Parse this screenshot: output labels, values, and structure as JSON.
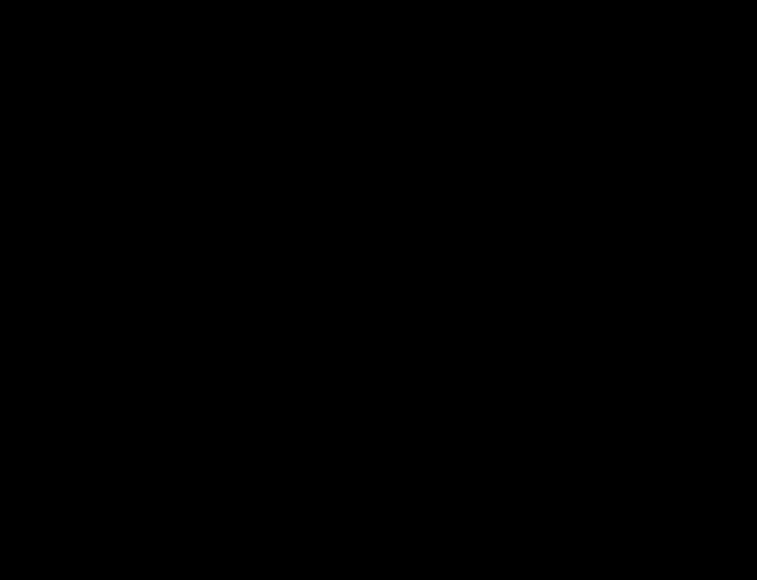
{
  "diagram": {
    "kind": "motherboard-boardview",
    "width": 757,
    "height": 580,
    "background": "#000000"
  },
  "palette": {
    "outline": "#dcdcdc",
    "outline_dim": "#8f8f8f",
    "label": "#bdbdbd",
    "label_dim": "#787878",
    "teal": "#3f9b85",
    "teal_bright": "#5cc2a7",
    "teal_dark": "#123b33"
  },
  "components": [
    {
      "id": "pq800-chip",
      "type": "chip",
      "label": "PQ800",
      "x": 59,
      "y": 21,
      "w": 36,
      "h": 26,
      "ellipse": true,
      "fs": 7
    },
    {
      "id": "pl50b-chip",
      "type": "chip",
      "label": "PL50B",
      "x": 208,
      "y": 18,
      "w": 33,
      "h": 33,
      "fs": 7,
      "corner": true
    },
    {
      "id": "eatxpwr-connector",
      "type": "atx24",
      "label": "EATXPWR",
      "x": 268,
      "y": 3,
      "w": 196,
      "h": 33,
      "fs": 17
    },
    {
      "id": "dimm-b1-slot",
      "type": "dimm",
      "label": "DIMM_B1",
      "x": 77,
      "y": 56,
      "w": 424,
      "h": 25,
      "fs": 16
    },
    {
      "id": "dimm-a1-slot",
      "type": "dimm",
      "label": "DIMM_A1",
      "x": 77,
      "y": 88,
      "w": 424,
      "h": 25,
      "fs": 16
    },
    {
      "id": "cpu-socket",
      "type": "cpu",
      "label": "LGA1150",
      "x": 162,
      "y": 142,
      "w": 170,
      "h": 246,
      "ix": 237,
      "iy": 243,
      "iw": 76,
      "ih": 50,
      "fs": 12
    },
    {
      "id": "alignment-crosshair",
      "type": "cross",
      "x": 362,
      "y": 283,
      "s": 44
    },
    {
      "id": "alignment-crosshair-small",
      "type": "cross",
      "x": 378,
      "y": 302,
      "s": 14
    },
    {
      "id": "pch-heatsink",
      "type": "bga",
      "label": "HEATSINK PCH",
      "x": 575,
      "y": 128,
      "w": 132,
      "h": 198,
      "gx": 601,
      "gy": 140,
      "gw": 70,
      "gh": 74,
      "fs": 12
    },
    {
      "id": "pciex16-slot",
      "type": "pcie",
      "label": "PCIEX16",
      "x": 527,
      "y": 116,
      "w": 26,
      "h": 305,
      "fs": 13
    },
    {
      "id": "f1u1-chip",
      "type": "chip",
      "label": "F1U1",
      "x": 573,
      "y": 30,
      "w": 31,
      "h": 33,
      "fs": 8,
      "pins": true
    },
    {
      "id": "sx1-chip",
      "type": "chip",
      "label": "SX1",
      "x": 682,
      "y": 66,
      "w": 22,
      "h": 33,
      "fs": 7,
      "vert": true
    },
    {
      "id": "sata6g-2-connector",
      "type": "sata",
      "label": "SATA6G_2",
      "x": 735,
      "y": 5,
      "w": 21,
      "h": 53
    },
    {
      "id": "sata6g-1-connector",
      "type": "sata",
      "label": "SATA6G_1",
      "x": 735,
      "y": 62,
      "w": 21,
      "h": 53
    },
    {
      "id": "sata3g-1-connector",
      "type": "sata",
      "label": "SATA3G_1",
      "x": 735,
      "y": 119,
      "w": 21,
      "h": 47
    },
    {
      "id": "sata3g-2-connector",
      "type": "sata",
      "label": "SATA3G_2",
      "x": 735,
      "y": 169,
      "w": 21,
      "h": 42
    },
    {
      "id": "pu100-chip",
      "type": "pucircle",
      "label": "PU100",
      "x": 556,
      "y": 346,
      "s": 30
    },
    {
      "id": "usb910-header",
      "type": "header",
      "label": "USB910",
      "x": 594,
      "y": 340,
      "w": 24,
      "h": 76,
      "rows": 9
    },
    {
      "id": "usb1112-header",
      "type": "header",
      "label": "USB1112",
      "x": 659,
      "y": 339,
      "w": 24,
      "h": 76,
      "rows": 9
    },
    {
      "id": "com1-header",
      "type": "header",
      "label": "COM1",
      "x": 720,
      "y": 360,
      "w": 19,
      "h": 82,
      "rows": 10
    },
    {
      "id": "panel-header",
      "type": "panel",
      "label": "PANEL",
      "x": 723,
      "y": 458,
      "w": 17,
      "h": 44
    },
    {
      "id": "ou1-chip",
      "type": "chip",
      "label": "OU1",
      "x": 601,
      "y": 476,
      "w": 35,
      "h": 31,
      "fs": 11,
      "thick": true
    },
    {
      "id": "au1-chip",
      "type": "chip",
      "label": "AU1",
      "x": 658,
      "y": 476,
      "w": 34,
      "h": 32,
      "fs": 11,
      "thick": true,
      "toppins": true
    },
    {
      "id": "pl1-inductor",
      "type": "inductor",
      "label": "PL1",
      "x": 88,
      "y": 385,
      "w": 32,
      "h": 29,
      "fs": 11
    },
    {
      "id": "pl2-inductor",
      "type": "inductor",
      "label": "PL2",
      "x": 197,
      "y": 385,
      "w": 32,
      "h": 29,
      "fs": 11
    },
    {
      "id": "pl3-inductor",
      "type": "inductor",
      "label": "PL3",
      "x": 252,
      "y": 385,
      "w": 33,
      "h": 30,
      "fs": 11
    },
    {
      "id": "ch309-choke",
      "type": "circlehatch",
      "label": "CH309",
      "x": 338,
      "y": 388,
      "w": 34,
      "h": 26
    },
    {
      "id": "kbms-port",
      "type": "iokbms",
      "label": "KBMS",
      "x": 28,
      "y": 497,
      "w": 56,
      "h": 52,
      "fs": 11
    },
    {
      "id": "dvi1-port",
      "type": "iodvi",
      "label": "DVI1",
      "x": 93,
      "y": 517,
      "w": 112,
      "h": 41,
      "fs": 14
    },
    {
      "id": "vga1-port",
      "type": "iovga",
      "label": "VGA1",
      "x": 225,
      "y": 533,
      "w": 96,
      "h": 23,
      "fs": 11
    },
    {
      "id": "usb12-port",
      "type": "iousb",
      "label": "USB12",
      "x": 337,
      "y": 502,
      "w": 51,
      "h": 36,
      "fs": 9
    },
    {
      "id": "lan-usb34-port",
      "type": "iolan",
      "label": "LAN_USB34",
      "x": 400,
      "y": 474,
      "w": 73,
      "h": 64,
      "fs": 9
    },
    {
      "id": "audio-port",
      "type": "ioaudio",
      "label": "AUDIO",
      "x": 478,
      "y": 497,
      "w": 50,
      "h": 56,
      "fs": 11
    },
    {
      "id": "speaker-buzzer",
      "type": "buzzer",
      "x": 692,
      "y": 524,
      "r": 11
    }
  ]
}
